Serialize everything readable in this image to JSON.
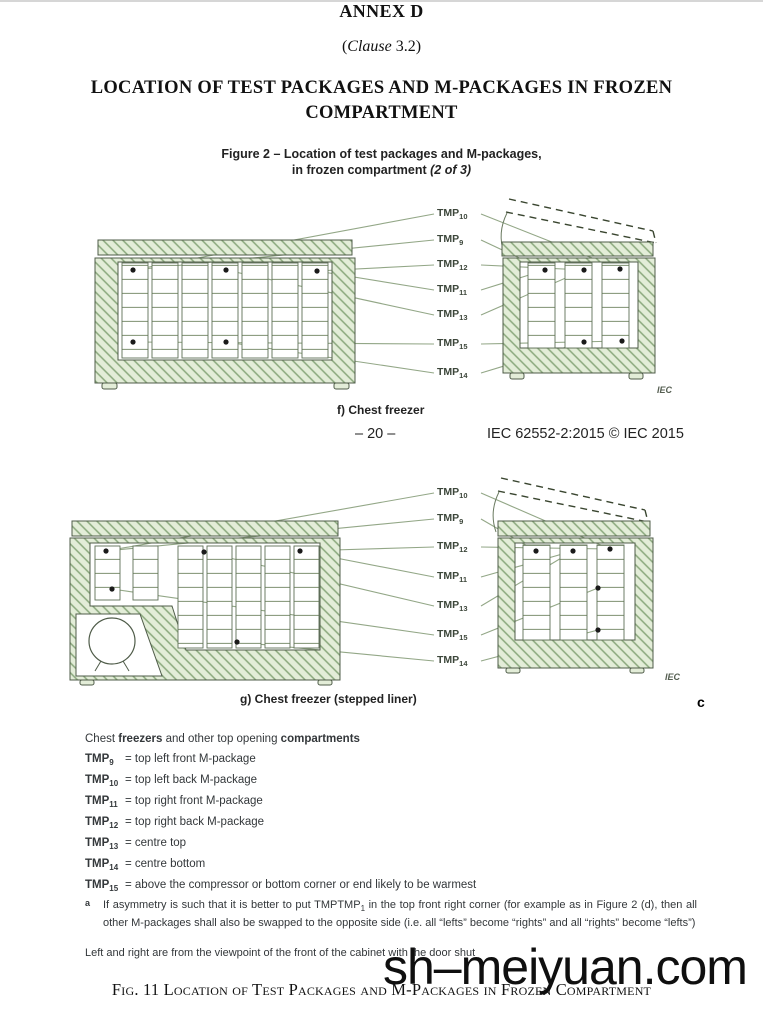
{
  "page": {
    "annex_title": "ANNEX D",
    "clause_open": "(",
    "clause_word": "Clause",
    "clause_rest": " 3.2)",
    "heading_line1": "LOCATION OF TEST PACKAGES AND M-PACKAGES IN FROZEN",
    "heading_line2": "COMPARTMENT",
    "figure_title_line1": "Figure 2 – Location of test packages and M-packages,",
    "figure_title_line2_normal": "in frozen compartment ",
    "figure_title_line2_italic": "(2 of 3)",
    "page_number": "– 20 –",
    "doc_ref": "IEC 62552-2:2015 © IEC 2015",
    "caption_f": "f) Chest freezer",
    "caption_g": "g) Chest freezer (stepped liner)",
    "stray_char": "c",
    "iec_credit": "IEC",
    "watermark": "sh–meiyuan.com",
    "fig11_caption": "Fig. 11 Location of Test Packages and M-Packages in Frozen Compartment"
  },
  "tmp": {
    "base": "TMP",
    "label_seq": [
      "10",
      "9",
      "12",
      "11",
      "13",
      "15",
      "14"
    ]
  },
  "legend": {
    "heading_p1": "Chest ",
    "heading_p2": "freezers",
    "heading_p3": " and other top opening ",
    "heading_p4": "compartments",
    "items": [
      {
        "sub": "9",
        "desc": "= top left front M-package"
      },
      {
        "sub": "10",
        "desc": "= top left back M-package"
      },
      {
        "sub": "11",
        "desc": "= top right front M-package"
      },
      {
        "sub": "12",
        "desc": "= top right back M-package"
      },
      {
        "sub": "13",
        "desc": "= centre top"
      },
      {
        "sub": "14",
        "desc": "= centre bottom"
      },
      {
        "sub": "15",
        "desc": "= above the compressor or bottom corner or end likely to be warmest"
      }
    ],
    "footnote_marker": "a",
    "footnote_pre": "If asymmetry is such that it is better to put TMP",
    "footnote_sub": "1",
    "footnote_post": " in the top front right corner (for example as in Figure 2 (d), then all other M-packages shall also be swapped to the opposite side (i.e. all “lefts” become “rights” and all “rights” become “lefts”)",
    "viewpoint_note": "Left and right are from the viewpoint of the front of the cabinet with the door shut"
  },
  "colors": {
    "wall_fill": "#e3edd8",
    "hatch_line": "#8aa87c",
    "outline": "#4f5c49",
    "leader_line": "#93a787",
    "dot": "#1a1a1a"
  }
}
